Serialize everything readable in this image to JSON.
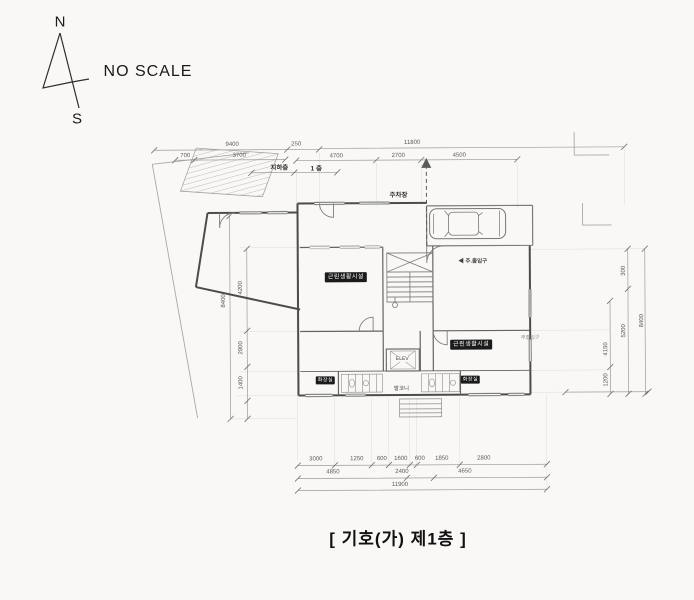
{
  "compass": {
    "north": "N",
    "south": "S"
  },
  "scale_note": "NO SCALE",
  "caption": "[ 기호(가) 제1층 ]",
  "labels": {
    "basement": "지하층",
    "first_floor": "1 층",
    "parking": "주차장",
    "main_entrance": "◀ 주.출입구",
    "sub_entrance": "부출입구",
    "balcony": "발코니",
    "elevator": "ELEV",
    "room_left": "근린생활시설",
    "room_right": "근린생활시설",
    "toilet_left": "화장실",
    "toilet_right": "화장실"
  },
  "dimensions": {
    "top": {
      "d9400": "9400",
      "d250": "250",
      "d11800": "11800",
      "d700": "700",
      "d3700": "3700",
      "d4700": "4700",
      "d2700": "2700",
      "d4500": "4500"
    },
    "left": {
      "d8400": "8400",
      "d4200": "4200",
      "d2800": "2800",
      "d1400": "1400"
    },
    "right": {
      "d300": "300",
      "d5200": "5200",
      "d8400": "8400",
      "d4150": "4150",
      "d1200": "1200"
    },
    "bottom": {
      "row1": [
        "3000",
        "1250",
        "600",
        "1600",
        "600",
        "1850",
        "2800"
      ],
      "row2": [
        "4850",
        "2400",
        "4650"
      ],
      "row3": "11900"
    }
  }
}
